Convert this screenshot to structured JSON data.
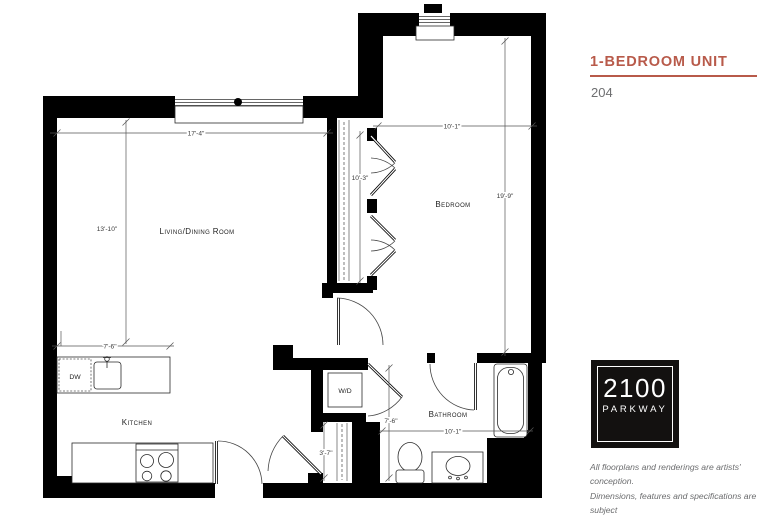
{
  "header": {
    "unit_type": "1-BEDROOM UNIT",
    "unit_number": "204"
  },
  "floorplan": {
    "rooms": {
      "living": "Living/Dining Room",
      "bedroom": "Bedroom",
      "kitchen": "Kitchen",
      "bathroom": "Bathroom",
      "washer_dryer": "W/D",
      "dishwasher": "DW"
    },
    "dimensions": {
      "living_width": "17'-4\"",
      "living_depth": "13'-10\"",
      "closet_length": "10'-3\"",
      "bedroom_width": "10'-1\"",
      "bedroom_length": "19'-9\"",
      "island_width": "7'-6\"",
      "bathroom_depth": "7'-6\"",
      "bathroom_width": "10'-1\"",
      "entry_closet_depth": "3'-7\""
    }
  },
  "logo": {
    "top": "2100",
    "bottom": "PARKWAY"
  },
  "disclaimer": {
    "line1": "All floorplans and renderings are artists' conception.",
    "line2": "Dimensions, features and specifications are subject",
    "line3": "to change at the discretion of the builder."
  },
  "colors": {
    "accent": "#b85a4a",
    "wall": "#000000",
    "unit_number_gray": "#6e6f71",
    "disclaimer_gray": "#6b6c6e"
  }
}
